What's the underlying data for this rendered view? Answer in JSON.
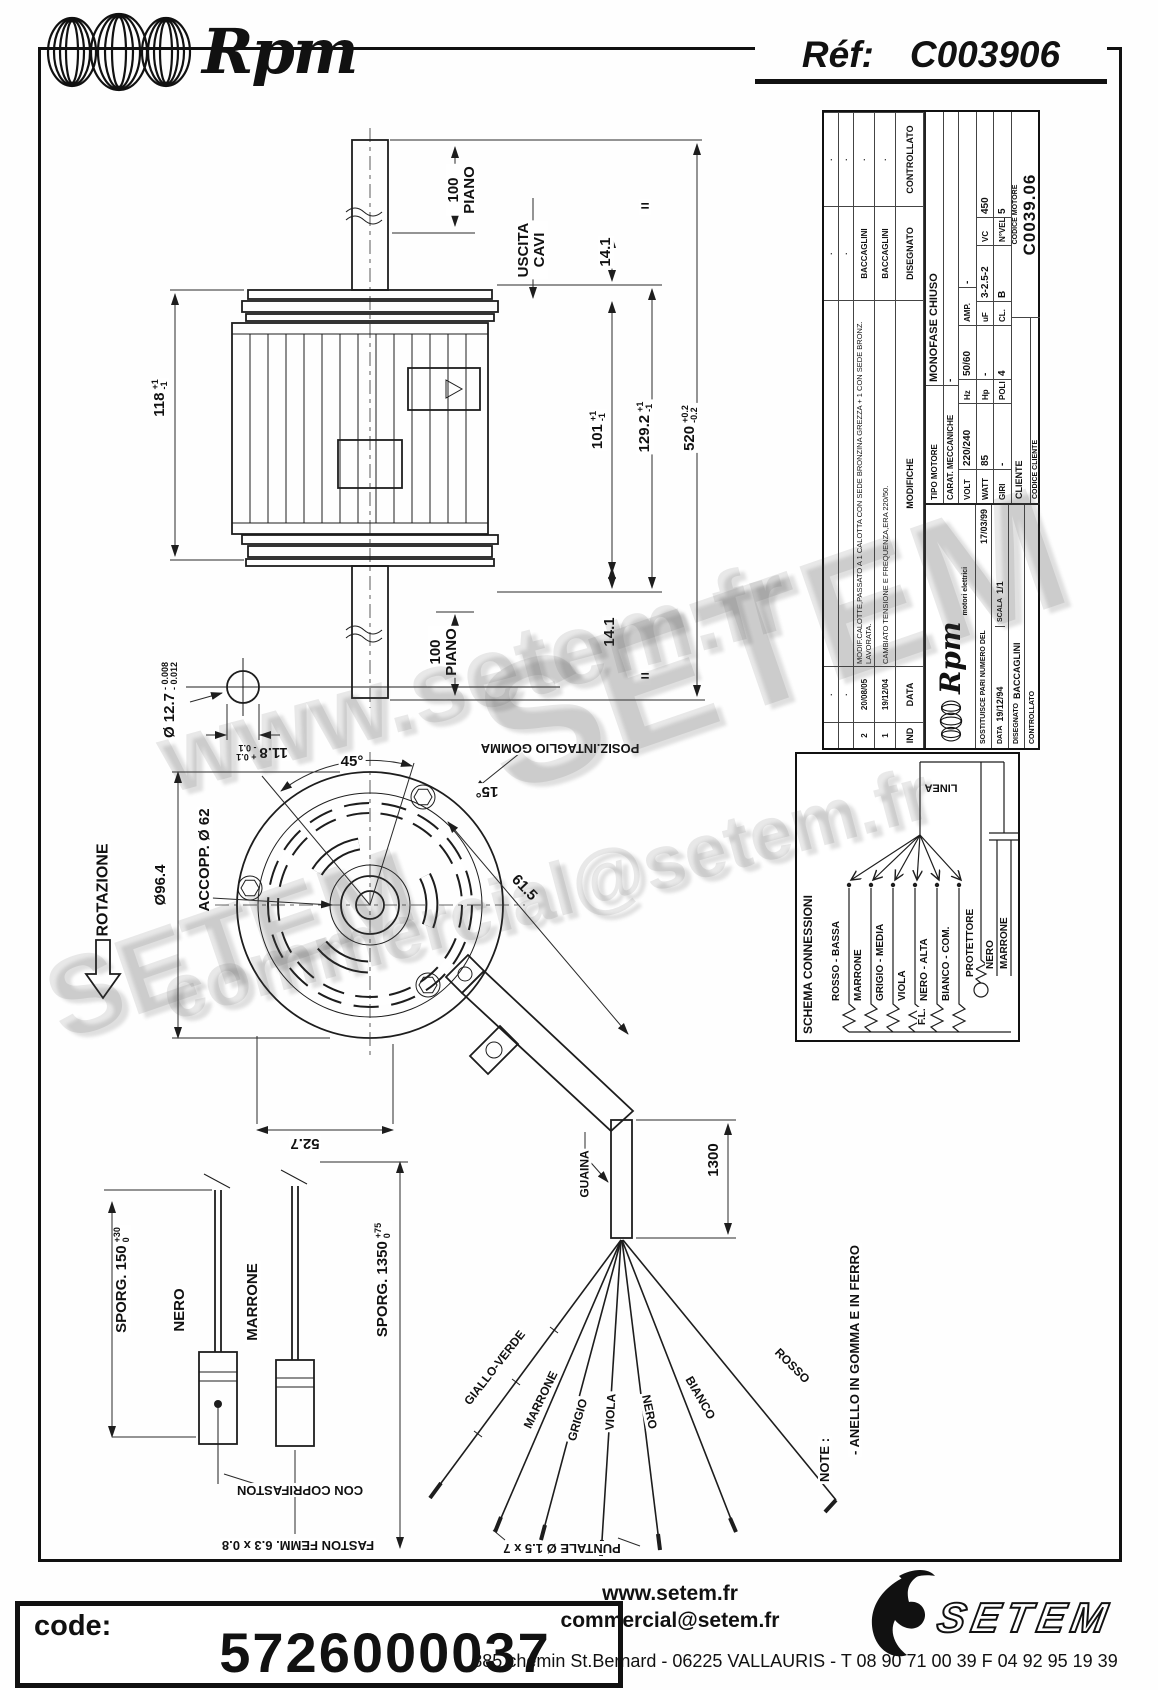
{
  "header": {
    "brand_script": "Rpm",
    "ref_label": "Réf:",
    "ref_value": "C003906"
  },
  "watermark": {
    "url": "www.setem.fr",
    "email": "commercial@setem.fr",
    "brand": "SETEM"
  },
  "side_view": {
    "shaft_top": [
      "100",
      "PIANO"
    ],
    "cable_exit": [
      "USCITA",
      "CAVI"
    ],
    "dim_141_top": "14.1",
    "equal_top": "=",
    "equal_bottom": "=",
    "dim_118": {
      "value": "118",
      "plus": "+1",
      "minus": "-1"
    },
    "dim_101": {
      "value": "101",
      "plus": "+1",
      "minus": "-1"
    },
    "dim_1292": {
      "value": "129.2",
      "plus": "+1",
      "minus": "-1"
    },
    "dim_520": {
      "value": "520",
      "plus": "+0.2",
      "minus": "-0.2"
    },
    "dim_141_bottom": "14.1",
    "shaft_bottom": [
      "100",
      "PIANO"
    ],
    "shaft_dia": {
      "value": "Ø 12.7",
      "plus": "- 0.008",
      "minus": "- 0.012"
    },
    "dim_118b": {
      "value": "11.8",
      "plus": "+ 0.1",
      "minus": "- 0.1"
    }
  },
  "front_view": {
    "rotazione": "ROTAZIONE",
    "dia_outer": "Ø96.4",
    "accopp": "ACCOPP. Ø 62",
    "angle_45": "45°",
    "angle_15": "15°",
    "posiz": "POSIZ.INTAGLIO GOMMA",
    "dim_527": "52.7",
    "dim_615": "61.5"
  },
  "leads": {
    "sporg_150": {
      "label": "SPORG. 150",
      "plus": "+30",
      "minus": "0"
    },
    "wire1": "NERO",
    "wire2": "MARRONE",
    "sporg_1350": {
      "label": "SPORG. 1350",
      "plus": "+75",
      "minus": "0"
    },
    "coprifaston": "CON COPRIFASTON",
    "faston": "FASTON FEMM. 6.3 x 0.8"
  },
  "splay": {
    "guaina": "GUAINA",
    "dim_1300": "1300",
    "wires": [
      "GIALLO-VERDE",
      "MARRONE",
      "GRIGIO",
      "VIOLA",
      "NERO",
      "BIANCO",
      "ROSSO"
    ],
    "puntale": "PUNTALE Ø 1.5 x 7"
  },
  "note": {
    "label": "NOTE :",
    "text": "- ANELLO IN GOMMA E IN FERRO"
  },
  "schema": {
    "title": "SCHEMA CONNESSIONI",
    "wires": [
      "ROSSO - BASSA",
      "MARRONE",
      "GRIGIO - MEDIA",
      "VIOLA",
      "NERO - ALTA",
      "BIANCO - COM."
    ],
    "protettore": "PROTETTORE",
    "nero": "NERO",
    "marrone": "MARRONE",
    "linea": "LINEA",
    "fl": "F.L."
  },
  "title_block": {
    "history": {
      "headers": {
        "ind": "IND",
        "data": "DATA",
        "modifiche": "MODIFICHE",
        "disegnato": "DISEGNATO",
        "controllato": "CONTROLLATO"
      },
      "rows": [
        {
          "ind": "",
          "data": "·",
          "text": "",
          "dis": "·",
          "ctr": "·"
        },
        {
          "ind": "",
          "data": "·",
          "text": "",
          "dis": "·",
          "ctr": "·"
        },
        {
          "ind": "2",
          "data": "20/08/05",
          "text": "MODIF.CALOTTE,PASSATO A 1 CALOTTA CON SEDE BRONZINA GREZZA + 1 CON SEDE BRONZ. LAVORATA.",
          "dis": "BACCAGLINI",
          "ctr": "·"
        },
        {
          "ind": "1",
          "data": "19/12/04",
          "text": "CAMBIATO TENSIONE E FREQUENZA,ERA 220/50.",
          "dis": "BACCAGLINI",
          "ctr": "·"
        }
      ]
    },
    "logo": {
      "brand": "Rpm",
      "sub": "motori elettrici"
    },
    "sostituisce_label": "SOSTITUISCE PARI NUMERO DEL",
    "sostituisce_date": "17/03/99",
    "data_label": "DATA",
    "data_value": "19/12/94",
    "scala_label": "SCALA",
    "scala_value": "1/1",
    "disegnato_label": "DISEGNATO",
    "disegnato_value": "BACCAGLINI",
    "controllato_label": "CONTROLLATO",
    "tipo_label": "TIPO MOTORE",
    "tipo_value": "MONOFASE CHIUSO",
    "carat_label": "CARAT. MECCANICHE",
    "carat_value": "-",
    "specs": {
      "volt_label": "VOLT",
      "volt": "220/240",
      "hz_label": "Hz",
      "hz": "50/60",
      "amp_label": "AMP.",
      "amp": "-",
      "watt_label": "WATT",
      "watt": "85",
      "hp_label": "Hp",
      "hp": "-",
      "uf_label": "uF",
      "uf": "3-2.5-2",
      "vc_label": "VC",
      "vc": "450",
      "giri_label": "GIRI",
      "giri": "-",
      "poli_label": "POLI",
      "poli": "4",
      "cl_label": "CL.",
      "cl": "B",
      "nvel_label": "N°VEL.",
      "nvel": "5"
    },
    "cliente_label": "CLIENTE",
    "codice_motore_label": "CODICE MOTORE",
    "codice_motore": "C0039.06",
    "codice_cliente_label": "CODICE CLIENTE"
  },
  "footer": {
    "code_label": "code:",
    "code_value": "5726000037",
    "site": "www.setem.fr",
    "email": "commercial@setem.fr",
    "address": "885 chemin St.Bernard  -  06225 VALLAURIS  -  T 08 90 71 00 39   F 04 92 95 19 39",
    "brand": "SETEM"
  }
}
